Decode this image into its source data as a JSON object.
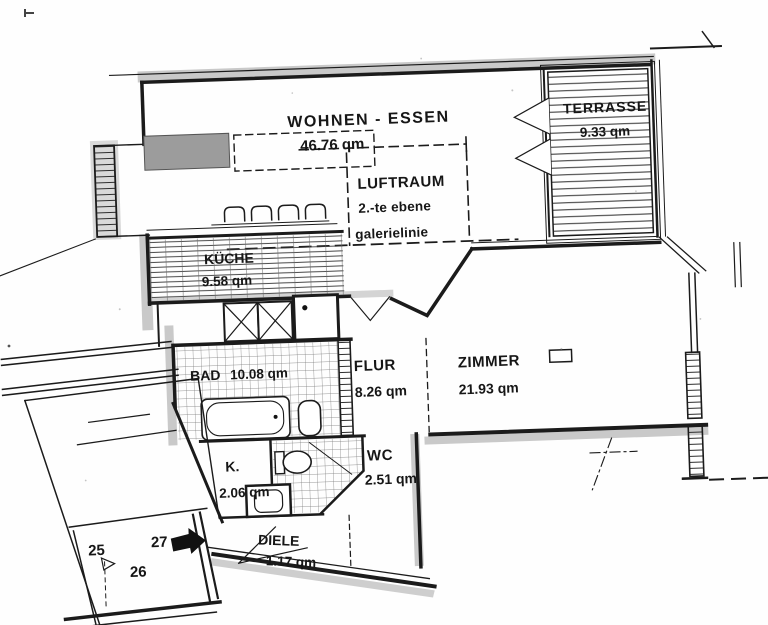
{
  "document": {
    "kind": "apartment-floor-plan-scan"
  },
  "rooms": {
    "wohnen_essen": {
      "name": "WOHNEN - ESSEN",
      "area": "46.76 qm"
    },
    "luftraum": {
      "name": "LUFTRAUM",
      "note1": "2.-te ebene",
      "note2": "galerielinie"
    },
    "terrasse": {
      "name": "TERRASSE",
      "area": "9.33 qm"
    },
    "kueche": {
      "name": "KÜCHE",
      "area": "9.58 qm"
    },
    "bad": {
      "name": "BAD",
      "area": "10.08 qm"
    },
    "flur": {
      "name": "FLUR",
      "area": "8.26 qm"
    },
    "zimmer": {
      "name": "ZIMMER",
      "area": "21.93 qm"
    },
    "kammer": {
      "name": "K.",
      "area": "2.06 qm"
    },
    "wc": {
      "name": "WC",
      "area": "2.51 qm"
    },
    "diele": {
      "name": "DIELE",
      "area": "1.17 qm"
    }
  },
  "parking": {
    "spot1": "25",
    "spot2": "26",
    "spot3": "27"
  },
  "colors": {
    "ink": "#1b1b1b",
    "wall_shade": "#c6c6c6",
    "paper": "#ffffff"
  }
}
